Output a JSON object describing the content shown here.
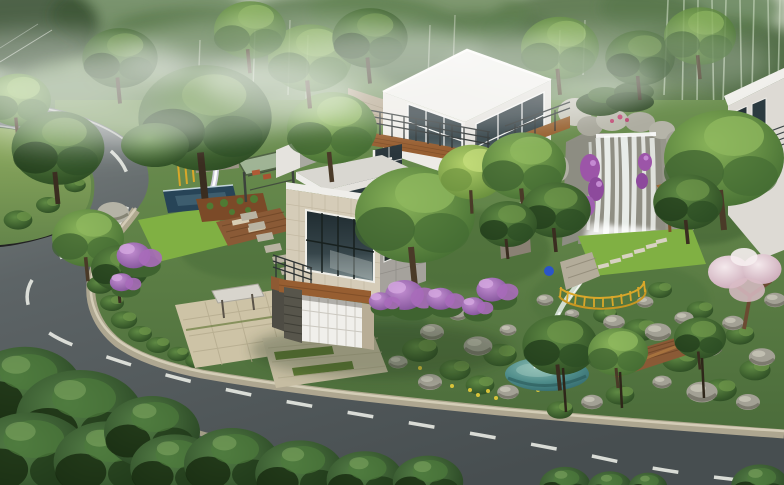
{
  "meta": {
    "type": "architectural-rendering",
    "description": "Aerial 3D visualization of a modern hillside villa estate: a hairpin asphalt road with dashed lane markings wraps around a landscaped property containing a white flat-roofed villa with stone cladding and wood balconies, a rock waterfall with purple bougainvillea, a teal garden pond with yellow safety fence, wooden decks, lawns, and dense misty forest behind."
  },
  "palette": {
    "forest_haze": "#c2cbba",
    "forest_mid": "#7f9a72",
    "forest_dark": "#3c5a33",
    "road": "#4e5557",
    "road_distant": "#7c8382",
    "road_marking": "#e6e8e2",
    "curb": "#b3ab93",
    "ground": "#5c8043",
    "lawn_bright": "#80b043",
    "tree_mid": "#4f7c38",
    "tree_light": "#76a24c",
    "tree_foreground": "#33542b",
    "house_white": "#f0efeb",
    "house_gray": "#a5a29c",
    "stone_beige": "#d5ccb8",
    "wood_brown": "#975e31",
    "window_glass": "#273339",
    "pond_teal": "#3f7c7e",
    "waterfall_rock": "#8f8e83",
    "water_white": "#f2f6f3",
    "flower_purple": "#9d63b0",
    "flower_blossom": "#e8d3da",
    "fence_yellow": "#d9a72a",
    "soil_brown": "#7b4a28"
  },
  "scene": {
    "objects": [
      {
        "name": "misty-forest-backdrop",
        "note": "hazy green woodland across the top with pale bamboo trunks at upper right"
      },
      {
        "name": "hairpin-road",
        "note": "two-lane asphalt road entering top-left, switchbacking around a grass bank and sweeping along the bottom to the right edge"
      },
      {
        "name": "lane-markings",
        "note": "white dashed center line following the curve"
      },
      {
        "name": "sidewalk-curb",
        "note": "light stone curb band along the property side of the road"
      },
      {
        "name": "grass-bank",
        "note": "grassy island inside the hairpin with a large tree"
      },
      {
        "name": "main-villa",
        "note": "stacked white modernist volumes, travertine-clad lower box, large dark glazed windows, wood balcony fascias, dark metal railings"
      },
      {
        "name": "garage",
        "note": "white paneled garage door, dark stacked-stone pillar, timber header beam, paver driveway with grass strips"
      },
      {
        "name": "entry-court",
        "note": "tan paved entrance court with canopy and steps"
      },
      {
        "name": "terrace-garden",
        "note": "lap pool, stone wall with water spout, glass pergola, timber deck with loungers, planting beds, bright lawn"
      },
      {
        "name": "rock-waterfall",
        "note": "tall gray stone cliff with white cascading water, purple bougainvillea and clipped pines on top"
      },
      {
        "name": "waterfall-lawn",
        "note": "lawn with diagonal stepping stones, timber arbor and bench"
      },
      {
        "name": "garden-stream",
        "note": "rocky stream running from the waterfall lawn down to the pond"
      },
      {
        "name": "garden-pond",
        "note": "teal pond with small inlet cascade"
      },
      {
        "name": "yellow-fence",
        "note": "curved yellow picket safety fence above the stream"
      },
      {
        "name": "wood-boardwalk",
        "note": "brown plank deck and curved boardwalk beside the pond"
      },
      {
        "name": "rock-garden",
        "note": "boulder-studded slope with shrubs between garden and road"
      },
      {
        "name": "purple-shrubs",
        "note": "violet flowering shrubs scattered through the planting"
      },
      {
        "name": "blossom-tree",
        "note": "pale pink flowering tree at the right edge"
      },
      {
        "name": "neighbor-house",
        "note": "partial second white villa at the far right"
      },
      {
        "name": "foreground-trees",
        "note": "dark blue-green canopies overlapping the road along the bottom edge"
      }
    ]
  }
}
